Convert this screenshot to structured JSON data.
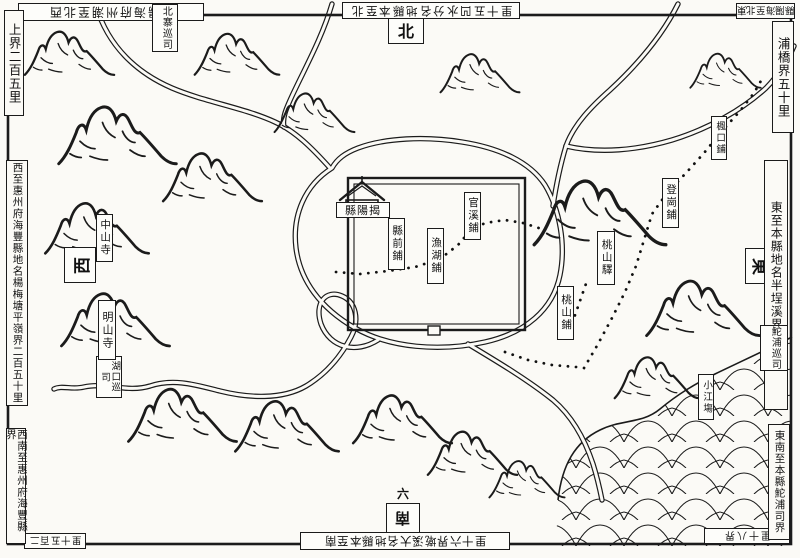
{
  "map": {
    "compass": {
      "north": "北",
      "south": "南",
      "east": "東",
      "west": "西"
    },
    "city": {
      "name": "揭陽縣",
      "name_display": "縣陽揭"
    },
    "stations": {
      "xianqian": "縣前鋪",
      "yuhu": "漁湖鋪",
      "guanxi": "官溪鋪",
      "taoshan_station": "桃山驛",
      "taoshan_post": "桃山鋪",
      "denggang": "登崗鋪",
      "fengkou": "楓口鋪",
      "xiaojiang": "小江塲"
    },
    "temples": {
      "zhongshan": "中山寺",
      "mingshan": "明山寺"
    },
    "offices": {
      "beizhai": "北寨巡司",
      "tuopu": "鮀浦巡司",
      "hukou": "湖口巡司"
    },
    "border_notes": {
      "top_left": "西北至潮州府海陽縣",
      "top_right": "北至本縣地名分水凹五十里",
      "top_corner": "東北至海陽縣",
      "left_top": "上界二百五里",
      "left_mid": "西至惠州府海豐縣地名楊梅塘平嶺界二百五十里",
      "left_bottom": "西南至惠州府海豐縣界",
      "bottom_left": "二百五十里",
      "bottom_center": "南至本縣地名大溪墘界六十里",
      "bottom_right": "界八十里",
      "right_top": "浦橋界五十里",
      "right_mid": "東至本縣地名半埕溪界一百里",
      "right_bottom": "東南至本縣鮀浦司界",
      "six": "六"
    }
  }
}
